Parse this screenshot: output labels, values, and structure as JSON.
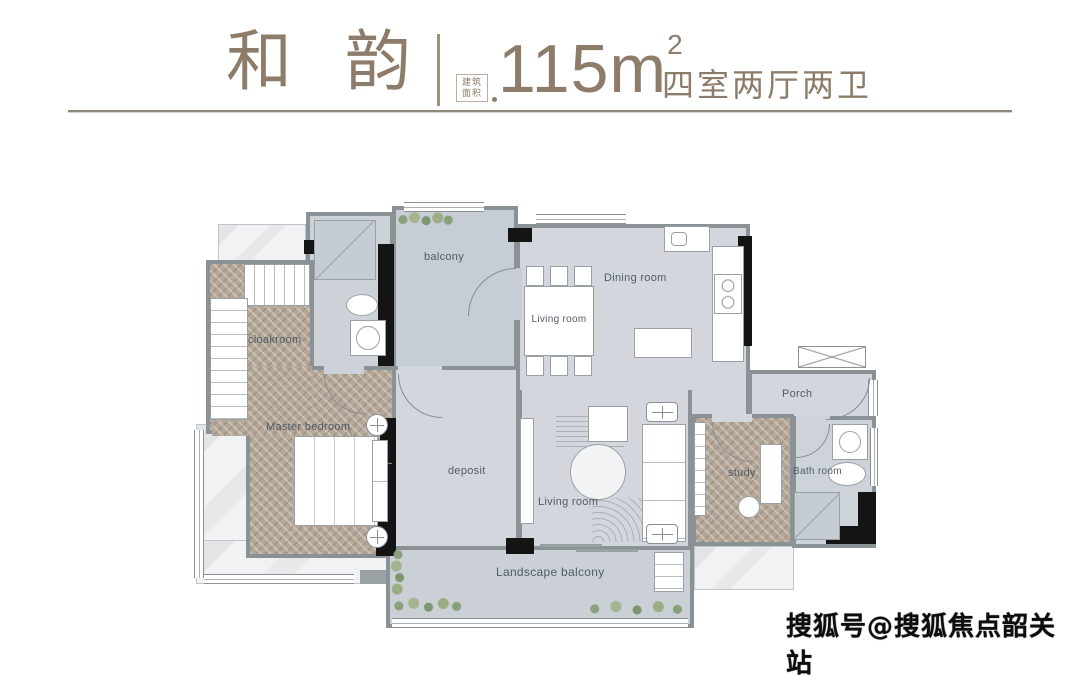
{
  "header": {
    "title": "和 韵",
    "area_stamp": {
      "line1": "建筑",
      "line2": "面积"
    },
    "area_value": "115m",
    "area_exponent": "2",
    "spec": "四室两厅两卫"
  },
  "plan": {
    "rooms": {
      "balcony": "balcony",
      "living_room_top": "Living room",
      "dining_room": "Dining room",
      "porch": "Porch",
      "cloakroom": "cloakroom",
      "master_bedroom": "Master bedroom",
      "deposit": "deposit",
      "living_room_bottom": "Living room",
      "study": "study",
      "bath_room": "Bath room",
      "landscape_balcony": "Landscape balcony"
    }
  },
  "watermark": "搜狐号@搜狐焦点韶关站",
  "colors": {
    "accent": "#8e7c6a",
    "floor": "#d3d7dd",
    "floor_dark": "#c7cdd5",
    "wood": "#b6a899",
    "wall": "#8b9296",
    "wall_black": "#141414",
    "label": "#4f5b66",
    "plant": "#8ba07c"
  }
}
